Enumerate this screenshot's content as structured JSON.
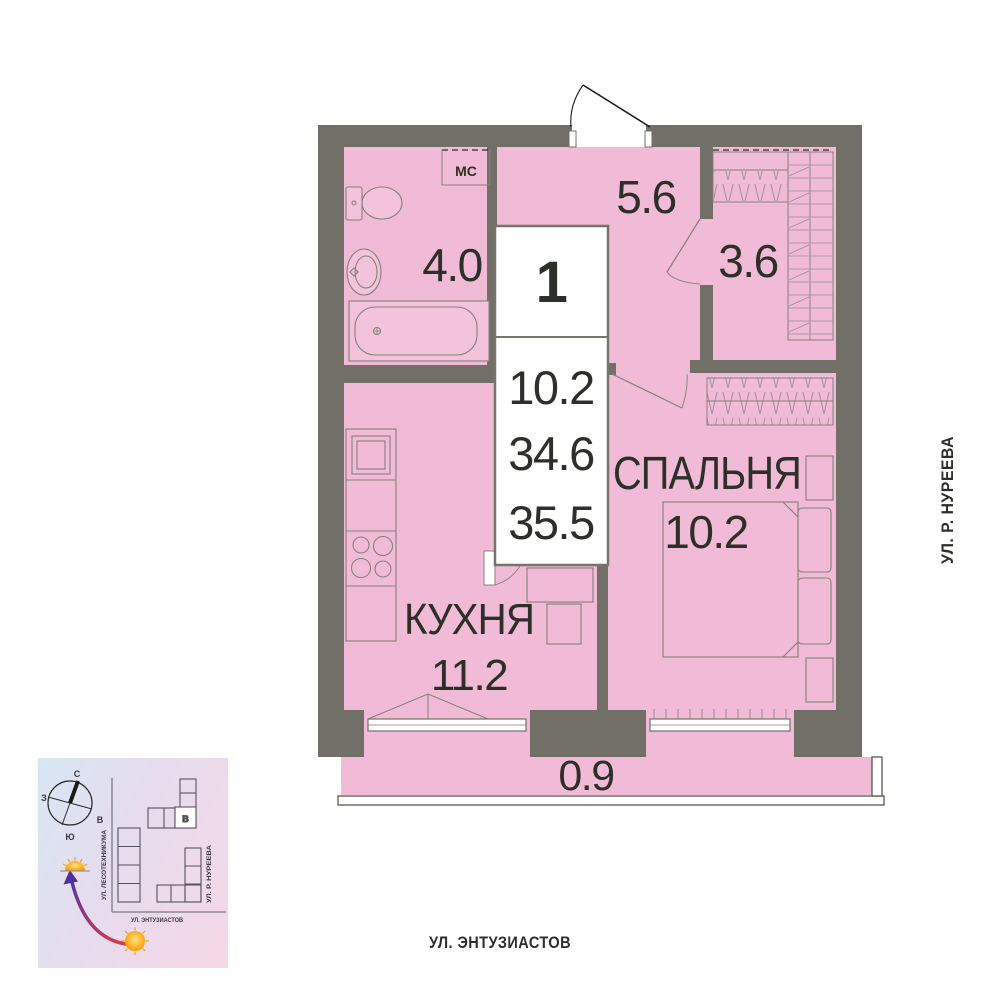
{
  "floor_plan": {
    "info_box": {
      "rooms_count": "1",
      "living_area": "10.2",
      "area_without_balcony": "34.6",
      "total_area": "35.5"
    },
    "rooms": [
      {
        "type": "bathroom",
        "name": "",
        "area": "4.0"
      },
      {
        "type": "hallway",
        "name": "",
        "area": "5.6"
      },
      {
        "type": "wardrobe",
        "name": "",
        "area": "3.6"
      },
      {
        "type": "bedroom",
        "name": "СПАЛЬНЯ",
        "area": "10.2"
      },
      {
        "type": "kitchen",
        "name": "КУХНЯ",
        "area": "11.2"
      },
      {
        "type": "balcony",
        "name": "",
        "area": "0.9"
      }
    ],
    "storage_label": "МС",
    "streets": {
      "right": "УЛ. Р. НУРЕЕВА",
      "bottom": "УЛ. ЭНТУЗИАСТОВ"
    }
  },
  "minimap": {
    "compass": {
      "north": "С",
      "south": "Ю",
      "west": "З",
      "east": "В"
    },
    "streets": {
      "left": "УЛ. ЛЕСОТЕХНИКУМА",
      "right": "УЛ. Р. НУРЕЕВА",
      "bottom": "УЛ. ЭНТУЗИАСТОВ"
    },
    "building_label": "В"
  },
  "colors": {
    "wall": "#716F67",
    "room_fill": "#F1BAD6",
    "furniture_line": "#84817A",
    "text": "#2D2F2B",
    "minimap_bg_from": "#D8E6F4",
    "minimap_bg_to": "#F6D8E6",
    "sun": "#F5A511",
    "arrow_from": "#E03A3F",
    "arrow_to": "#5A35A5"
  }
}
